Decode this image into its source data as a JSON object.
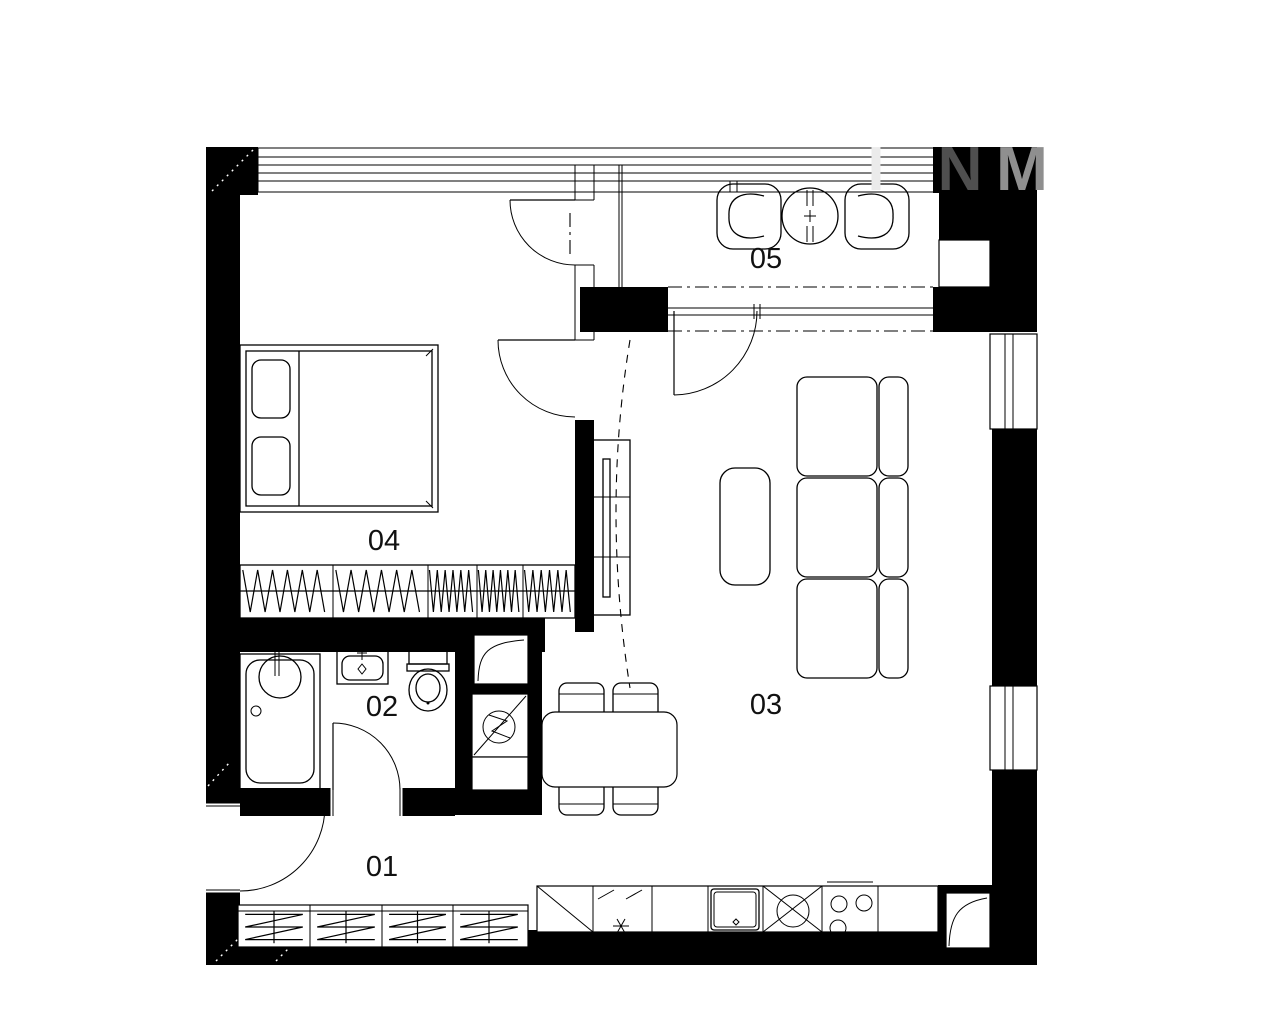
{
  "watermark": {
    "letters": [
      {
        "char": "I",
        "color": "#ebebeb"
      },
      {
        "char": "N",
        "color": "#4f4f4f"
      },
      {
        "char": "M",
        "color": "#8f8f8f"
      }
    ]
  },
  "rooms": [
    {
      "label": "01"
    },
    {
      "label": "02"
    },
    {
      "label": "03"
    },
    {
      "label": "04"
    },
    {
      "label": "05"
    }
  ],
  "colors": {
    "background": "#ffffff",
    "wall": "#000000",
    "label": "#111111"
  }
}
